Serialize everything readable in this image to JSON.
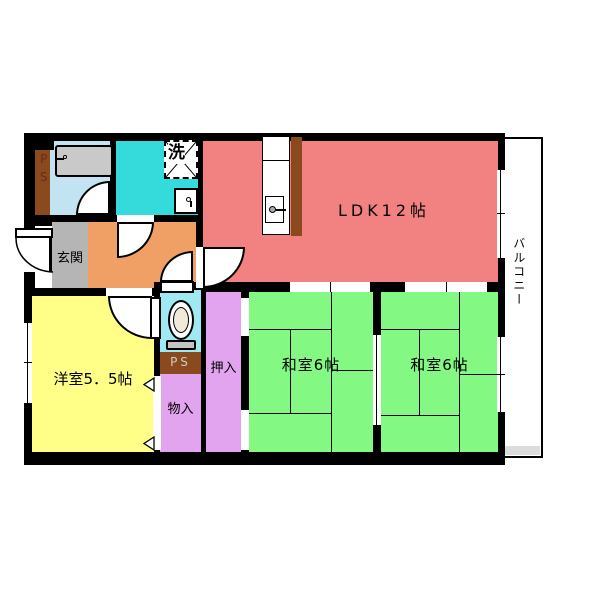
{
  "plan": {
    "rooms": {
      "ldk": {
        "label": "LDK12帖"
      },
      "washitsu_left": {
        "label": "和室6帖"
      },
      "washitsu_right": {
        "label": "和室6帖"
      },
      "youshitsu": {
        "label": "洋室5．5帖"
      },
      "genkan": {
        "label": "玄関"
      },
      "oshiire": {
        "label": "押入"
      },
      "monoire": {
        "label": "物入"
      },
      "balcony": {
        "label": "バルコニー"
      },
      "ps_shaft_left": {
        "label": "PS"
      },
      "ps_shaft_lower": {
        "label": "PS"
      },
      "laundry": {
        "label": "洗"
      }
    },
    "colors": {
      "wall": "#000000",
      "ldk": "#f28282",
      "tatami_green": "#83f883",
      "youshitsu_yellow": "#ffff88",
      "closet_violet": "#e2a4ee",
      "toilet_cyan": "#9fe9f2",
      "washroom_cyan": "#35dada",
      "bathroom_blue": "#c2e4f2",
      "hallway_orange": "#f0a064",
      "genkan_gray": "#b5b5b5",
      "ps_brown": "#8a4a1e",
      "tub_gray": "#c9c9c9",
      "balcony_edge_gray": "#dcdcdc",
      "ps_left_text": "#6e2815",
      "ps_lower_text": "#cccccc"
    }
  }
}
